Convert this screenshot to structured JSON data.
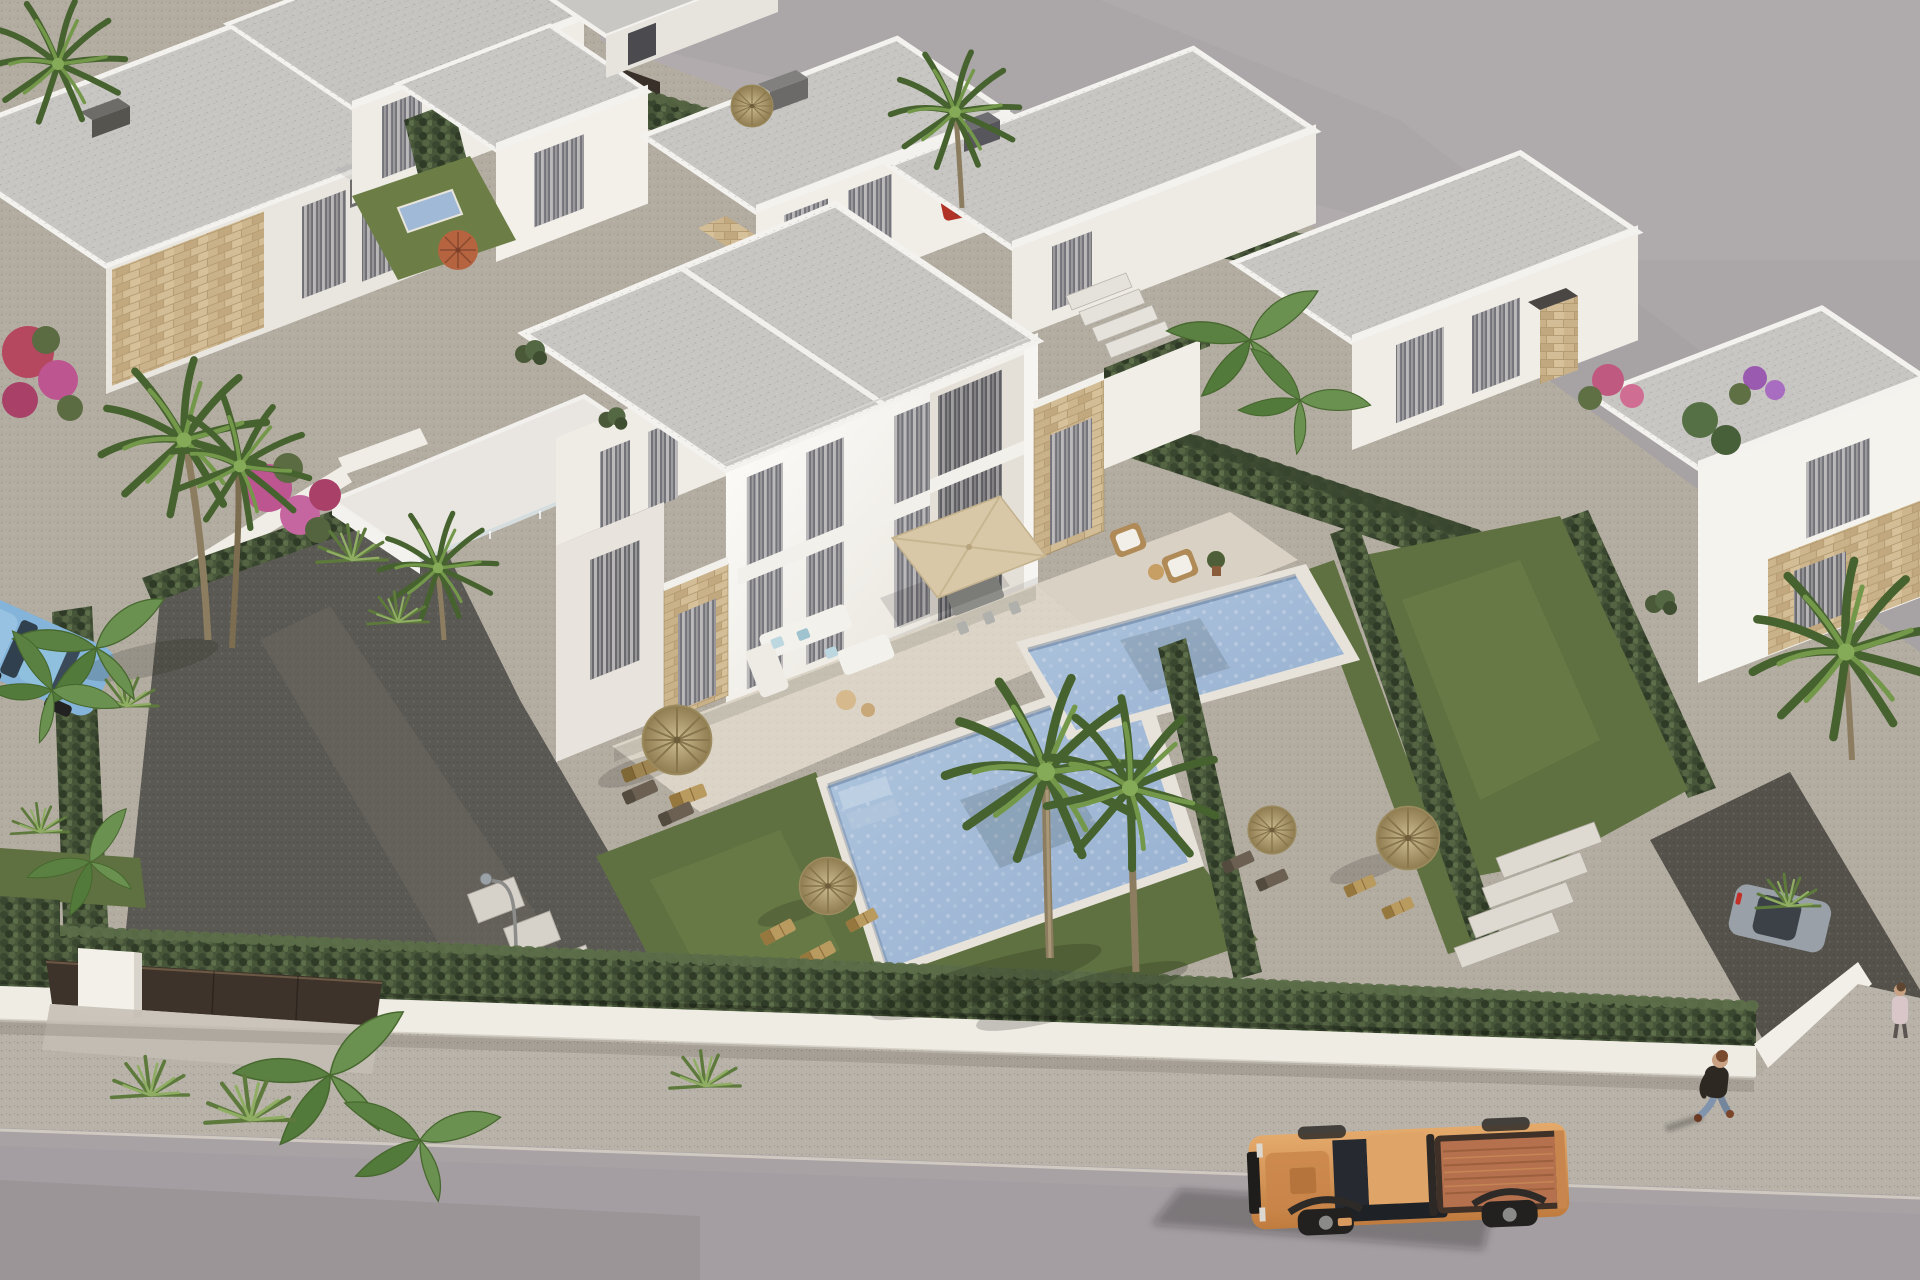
{
  "meta": {
    "title": "Aerial render — villa development",
    "description": "Aerial 3D architectural rendering of a modern white villa development: semi-detached two-storey villas with stone accents, private pools, hedged gardens, palm trees, thatched parasols, a perimeter wall with a dark gate, a street with an orange pickup truck, a pedestrian and parked cars.",
    "view": "aerial-oblique",
    "time_of_day": "day"
  },
  "colors": {
    "vacant": "#a7a2a4",
    "gravel_light": "#b3aca1",
    "gravel_dark": "#5b5954",
    "road": "#a49da1",
    "sidewalk": "#b8b2a8",
    "wall": "#efece4",
    "gate": "#3e332a",
    "hedge": "#475538",
    "hedge_light": "#5d6f4a",
    "lawn": "#5f7140",
    "lawn_light": "#70824a",
    "roof": "#c8c6c3",
    "parapet": "#f4f2ee",
    "facade": "#f1eee8",
    "stone": "#c8b28a",
    "terrace": "#e9e6e1",
    "deck": "#dcd5c7",
    "pool_rim": "#e7e3da",
    "pool_water": "#9fb9d6",
    "parasol": "#d8c8a8",
    "thatch": "#b5a478",
    "truck_body": "#dfa468",
    "truck_bed": "#b5714d",
    "jeans": "#8095ad",
    "car_blue": "#84b4d9",
    "car_gray": "#99a0a8",
    "car_red": "#b13227",
    "palm": "#5d7d3d",
    "trunk": "#8d7d60",
    "bougainvillea": "#bc5590"
  },
  "scene": {
    "buildings": {
      "style": "modern flat-roof white villas with travertine stone accents",
      "main_villa": {
        "stories": 2,
        "units": 2,
        "features": [
          "roof terrace with glass balustrade",
          "beige square parasol",
          "outdoor dining set",
          "white corner sofa with blue cushions",
          "wicker armchairs",
          "sun loungers"
        ]
      },
      "background_villas": 8
    },
    "pools": [
      {
        "shape": "rectangular",
        "water": "light blue mosaic"
      },
      {
        "shape": "rectangular",
        "water": "light blue mosaic"
      }
    ],
    "vegetation": {
      "fan_palms": 8,
      "banana_plants": 5,
      "palmettos": 6,
      "hedges": "clipped cypress rows",
      "bougainvillea_clusters": 4,
      "thatch_parasols": 6,
      "terracotta_parasol": 1
    },
    "street": {
      "vehicles": [
        {
          "type": "pickup-truck",
          "color": "orange",
          "state": "driving on road"
        },
        {
          "type": "hatchback",
          "color": "light blue",
          "state": "parked left, behind banana plants"
        },
        {
          "type": "suv",
          "color": "gray",
          "state": "parked right driveway"
        },
        {
          "type": "car",
          "color": "red",
          "state": "parked back plot"
        },
        {
          "type": "car",
          "color": "dark gray",
          "state": "back road"
        }
      ],
      "pedestrians": 2,
      "street_lamps": 1,
      "gate": {
        "color": "dark brown",
        "type": "sliding panel"
      }
    }
  }
}
